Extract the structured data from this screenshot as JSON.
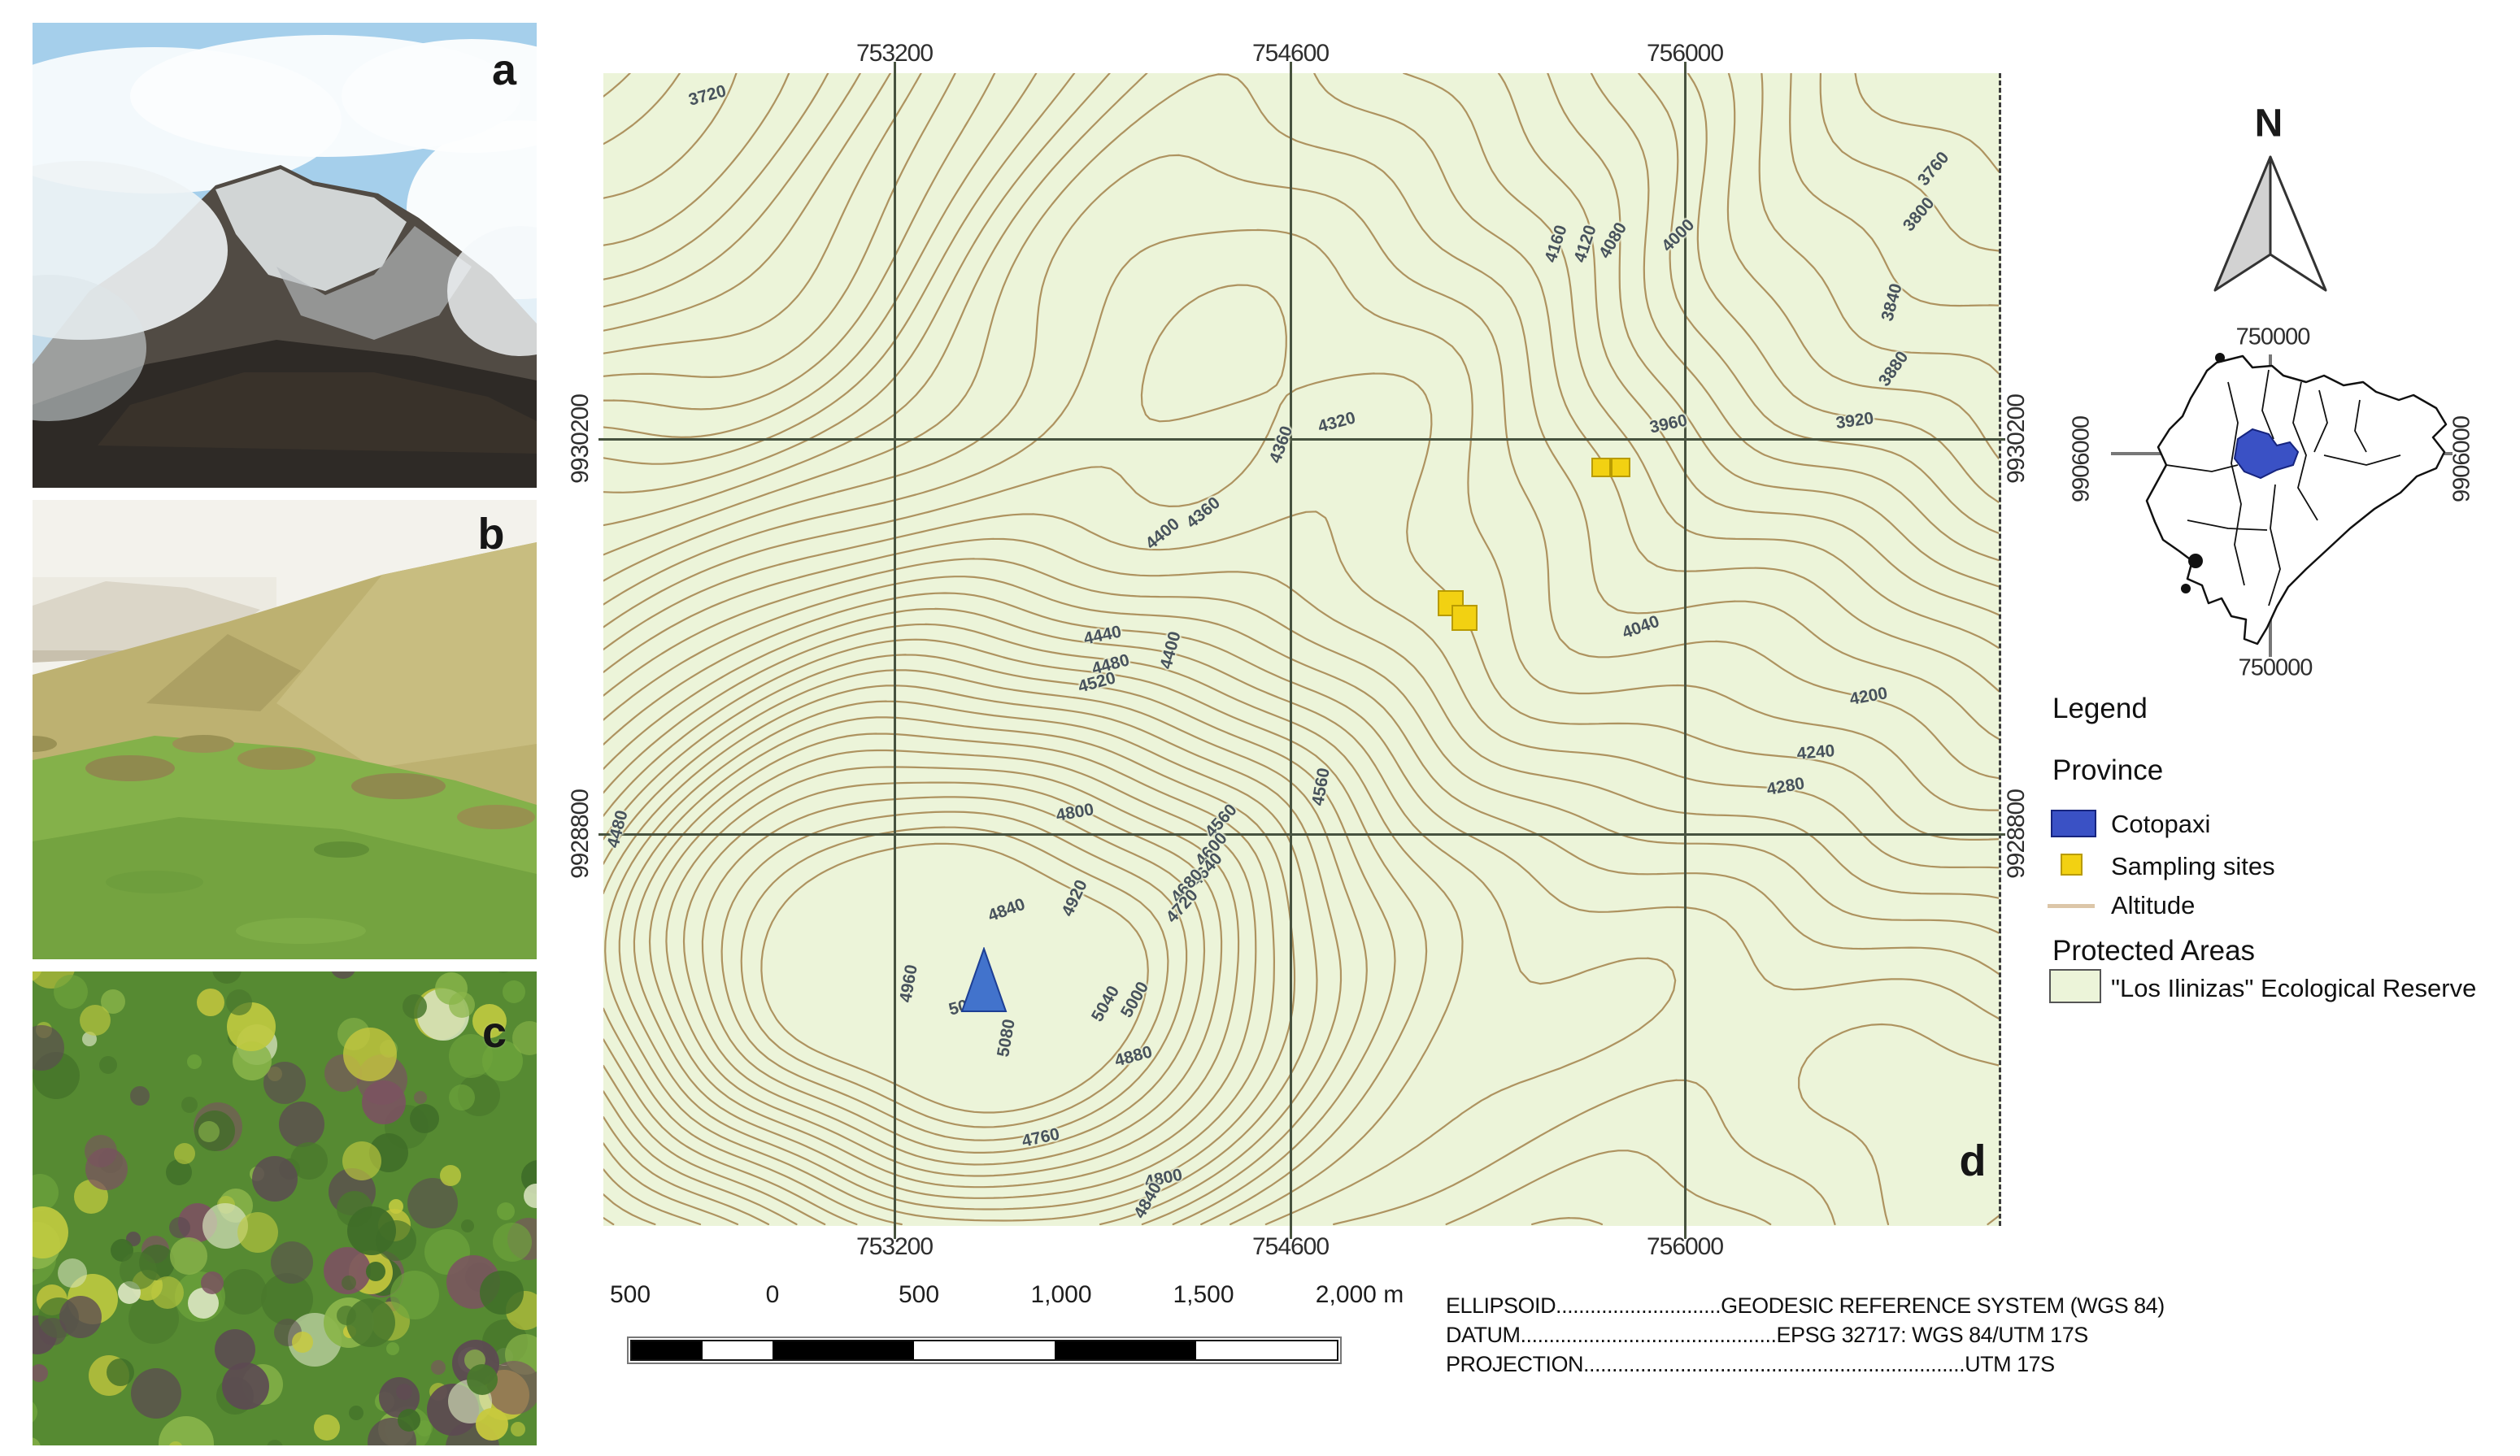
{
  "panels": {
    "a": "a",
    "b": "b",
    "c": "c",
    "d": "d"
  },
  "map": {
    "x_ticks": [
      {
        "label": "753200",
        "x": 1100
      },
      {
        "label": "754600",
        "x": 1587
      },
      {
        "label": "756000",
        "x": 2072
      }
    ],
    "y_ticks": [
      {
        "label": "9930200",
        "y": 540
      },
      {
        "label": "9928800",
        "y": 1026
      }
    ],
    "contour_labels": [
      {
        "t": "3720",
        "x": 870,
        "y": 118,
        "r": -15
      },
      {
        "t": "4160",
        "x": 1914,
        "y": 300,
        "r": -72
      },
      {
        "t": "4120",
        "x": 1950,
        "y": 300,
        "r": -72
      },
      {
        "t": "4080",
        "x": 1984,
        "y": 296,
        "r": -60
      },
      {
        "t": "4000",
        "x": 2064,
        "y": 290,
        "r": -45
      },
      {
        "t": "3760",
        "x": 2378,
        "y": 208,
        "r": -50
      },
      {
        "t": "3800",
        "x": 2360,
        "y": 264,
        "r": -50
      },
      {
        "t": "3840",
        "x": 2327,
        "y": 372,
        "r": -75
      },
      {
        "t": "3880",
        "x": 2329,
        "y": 454,
        "r": -55
      },
      {
        "t": "3920",
        "x": 2281,
        "y": 518,
        "r": -8
      },
      {
        "t": "4320",
        "x": 1644,
        "y": 520,
        "r": -15
      },
      {
        "t": "3960",
        "x": 2052,
        "y": 522,
        "r": -12
      },
      {
        "t": "4360",
        "x": 1576,
        "y": 547,
        "r": -70
      },
      {
        "t": "4360",
        "x": 1480,
        "y": 631,
        "r": -40
      },
      {
        "t": "4400",
        "x": 1430,
        "y": 657,
        "r": -40
      },
      {
        "t": "4440",
        "x": 1356,
        "y": 782,
        "r": -12
      },
      {
        "t": "4480",
        "x": 1366,
        "y": 818,
        "r": -15
      },
      {
        "t": "4520",
        "x": 1349,
        "y": 840,
        "r": -15
      },
      {
        "t": "4400",
        "x": 1440,
        "y": 800,
        "r": -75
      },
      {
        "t": "4040",
        "x": 2018,
        "y": 772,
        "r": -20
      },
      {
        "t": "4200",
        "x": 2298,
        "y": 857,
        "r": -10
      },
      {
        "t": "4240",
        "x": 2233,
        "y": 926,
        "r": -5
      },
      {
        "t": "4280",
        "x": 2196,
        "y": 968,
        "r": -10
      },
      {
        "t": "4480",
        "x": 760,
        "y": 1020,
        "r": -75
      },
      {
        "t": "4800",
        "x": 1322,
        "y": 1000,
        "r": -10
      },
      {
        "t": "4560",
        "x": 1502,
        "y": 1010,
        "r": -48
      },
      {
        "t": "4600",
        "x": 1490,
        "y": 1045,
        "r": -48
      },
      {
        "t": "4640",
        "x": 1484,
        "y": 1070,
        "r": -48
      },
      {
        "t": "4680",
        "x": 1460,
        "y": 1090,
        "r": -48
      },
      {
        "t": "4720",
        "x": 1454,
        "y": 1115,
        "r": -48
      },
      {
        "t": "4920",
        "x": 1322,
        "y": 1105,
        "r": -65
      },
      {
        "t": "4840",
        "x": 1238,
        "y": 1120,
        "r": -20
      },
      {
        "t": "4960",
        "x": 1118,
        "y": 1210,
        "r": -80
      },
      {
        "t": "5080",
        "x": 1190,
        "y": 1237,
        "r": -15
      },
      {
        "t": "5040",
        "x": 1360,
        "y": 1235,
        "r": -60
      },
      {
        "t": "5000",
        "x": 1396,
        "y": 1230,
        "r": -60
      },
      {
        "t": "5080",
        "x": 1238,
        "y": 1277,
        "r": -80
      },
      {
        "t": "4880",
        "x": 1394,
        "y": 1300,
        "r": -15
      },
      {
        "t": "4560",
        "x": 1625,
        "y": 968,
        "r": -80
      },
      {
        "t": "4760",
        "x": 1280,
        "y": 1400,
        "r": -12
      },
      {
        "t": "4800",
        "x": 1431,
        "y": 1450,
        "r": -12
      },
      {
        "t": "4840",
        "x": 1412,
        "y": 1477,
        "r": -60
      }
    ],
    "peak_marker": {
      "x": 1210,
      "y": 1206,
      "w": 58,
      "h": 82
    },
    "sampling_sites": [
      {
        "x": 1957,
        "y": 563,
        "s": 24
      },
      {
        "x": 1981,
        "y": 563,
        "s": 24
      },
      {
        "x": 1768,
        "y": 726,
        "s": 32
      },
      {
        "x": 1785,
        "y": 744,
        "s": 32
      }
    ],
    "colors": {
      "reserve_fill": "#ecf4d9",
      "contour": "#a5854f",
      "grid": "#47523f",
      "site_fill": "#f2d112",
      "province_blue": "#3a51c5"
    }
  },
  "scale": {
    "labels": [
      "500",
      "0",
      "500",
      "1,000",
      "1,500",
      "2,000 m"
    ]
  },
  "credits": {
    "l1": "ELLIPSOID.............................GEODESIC REFERENCE SYSTEM (WGS 84)",
    "l2": "DATUM.............................................EPSG 32717: WGS 84/UTM 17S",
    "l3": "PROJECTION...................................................................UTM 17S"
  },
  "north": {
    "label": "N"
  },
  "inset": {
    "top": "750000",
    "bottom": "750000",
    "left": "9906000",
    "right": "9906000"
  },
  "legend": {
    "title": "Legend",
    "province_heading": "Province",
    "items": {
      "cotopaxi": "Cotopaxi",
      "sampling": "Sampling sites",
      "altitude": "Altitude"
    },
    "protected_heading": "Protected Areas",
    "reserve": "\"Los Ilinizas\" Ecological Reserve"
  }
}
